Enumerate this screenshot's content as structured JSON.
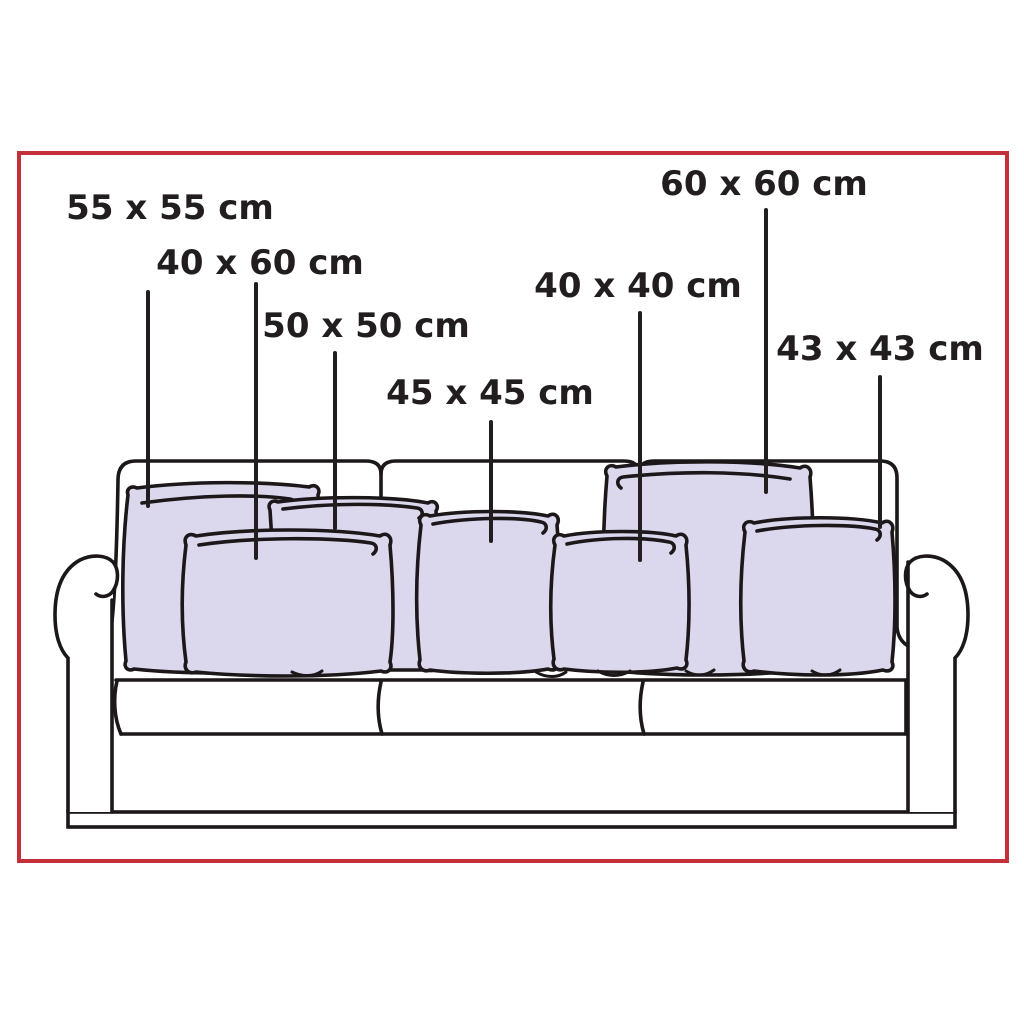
{
  "diagram": {
    "name": "sofa-throw-pillow-size-guide",
    "background_color": "#ffffff",
    "border_color": "#c4303a",
    "outline_color": "#1c1719",
    "pillow_fill_color": "#dbd7ec",
    "unit": "cm",
    "pillow_labels": [
      {
        "id": "55x55",
        "text": "55 x 55 cm",
        "width_cm": 55,
        "height_cm": 55
      },
      {
        "id": "40x60",
        "text": "40 x 60 cm",
        "width_cm": 60,
        "height_cm": 40
      },
      {
        "id": "50x50",
        "text": "50 x 50 cm",
        "width_cm": 50,
        "height_cm": 50
      },
      {
        "id": "45x45",
        "text": "45 x 45 cm",
        "width_cm": 45,
        "height_cm": 45
      },
      {
        "id": "40x40",
        "text": "40 x 40 cm",
        "width_cm": 40,
        "height_cm": 40
      },
      {
        "id": "60x60",
        "text": "60 x 60 cm",
        "width_cm": 60,
        "height_cm": 60
      },
      {
        "id": "43x43",
        "text": "43 x 43 cm",
        "width_cm": 43,
        "height_cm": 43
      }
    ]
  }
}
